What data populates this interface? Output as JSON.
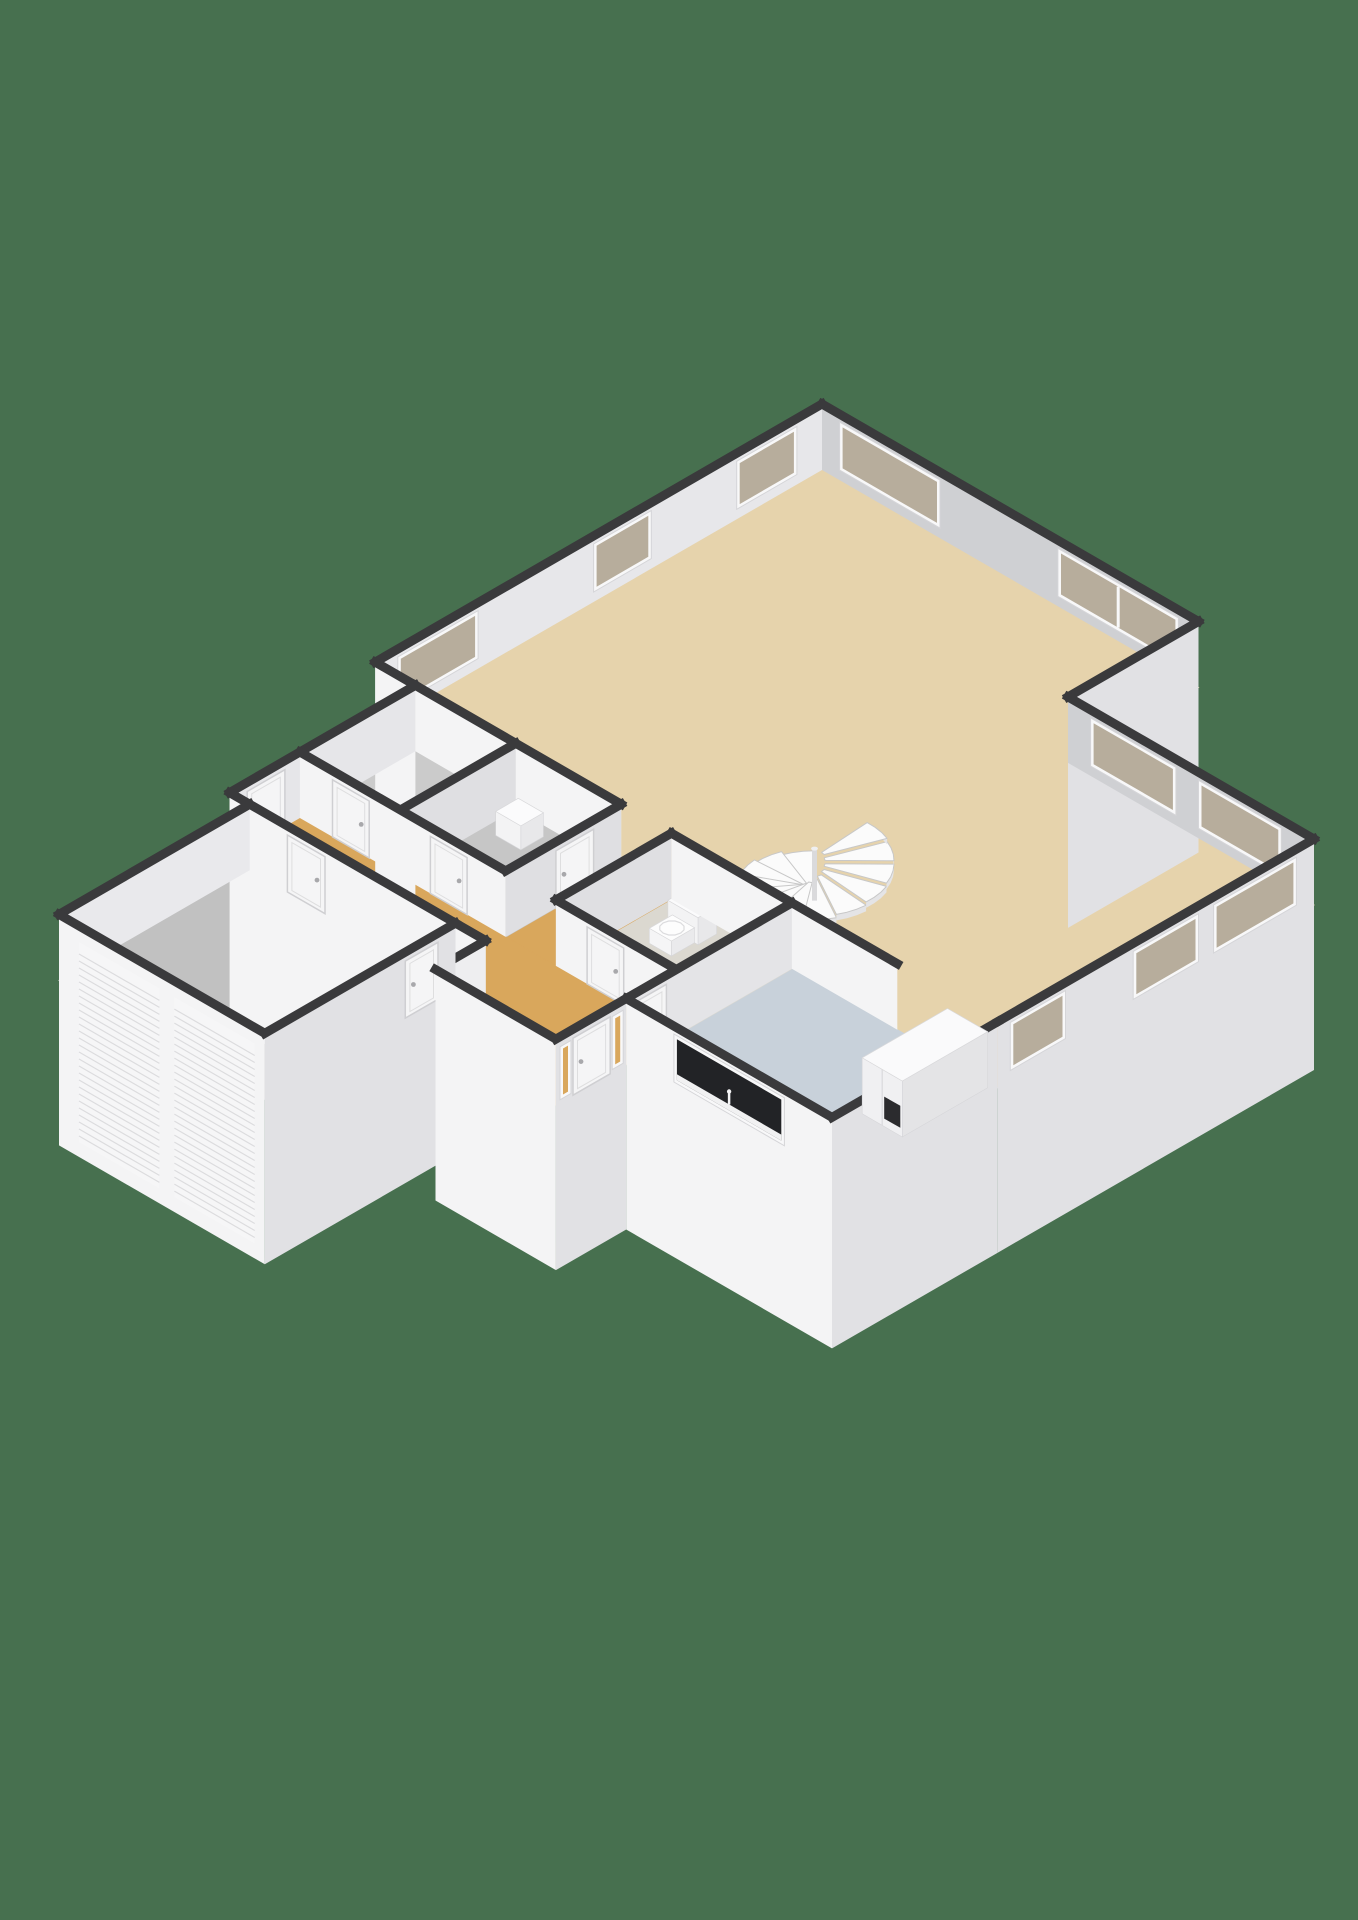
{
  "scene": {
    "title": "3d-floorplan-ground-floor",
    "background": "#47704F",
    "wall_cap": "#3a3a3c",
    "face_light": "#f4f4f5",
    "face_dark": "#e1e1e4",
    "frame": "#f8f8f9",
    "frame_stroke": "#d5d5d8",
    "glass_beige": "#b7ad9c",
    "glass_dark": "#222326",
    "glass_orange": "#d9a75c",
    "step_top": "#fbfbfb",
    "step_edge": "#c8c8c8",
    "step_riser": "#e4e4e6",
    "slat_line": "#dcdcde",
    "door_fill": "#f5f5f6",
    "door_stroke": "#cfcfd2",
    "handle": "#a8a8ab"
  },
  "iso": {
    "cx": 822,
    "cy": 470,
    "hx": 50.2,
    "vy": 29,
    "wall_h": 66,
    "skirt": 165,
    "cap_w": 9
  },
  "rooms": [
    {
      "id": "living-room",
      "color": "#e6d3ac"
    },
    {
      "id": "kitchen",
      "color": "#c8d1da"
    },
    {
      "id": "wc",
      "color": "#dbd8d0"
    },
    {
      "id": "corridor",
      "color": "#d9a75c"
    },
    {
      "id": "storage-a",
      "color": "#cbcbcb"
    },
    {
      "id": "storage-b",
      "color": "#c6c6c6"
    },
    {
      "id": "hallway",
      "color": "#d9a75c"
    },
    {
      "id": "garage",
      "color": "#c1c1c1"
    }
  ],
  "floors": [
    {
      "name": "floor-living-room",
      "color": "#e6d3ac",
      "pts": [
        [
          0,
          0
        ],
        [
          7.5,
          0
        ],
        [
          7.5,
          2.6
        ],
        [
          12.4,
          2.6
        ],
        [
          12.4,
          8.9
        ],
        [
          0,
          8.9
        ]
      ]
    },
    {
      "name": "floor-kitchen",
      "color": "#c8d1da",
      "pts": [
        [
          8.3,
          8.9
        ],
        [
          12.4,
          8.9
        ],
        [
          12.4,
          12.2
        ],
        [
          8.3,
          12.2
        ]
      ]
    },
    {
      "name": "floor-wc",
      "color": "#dbd8d0",
      "pts": [
        [
          5.9,
          8.9
        ],
        [
          8.3,
          8.9
        ],
        [
          8.3,
          11.2
        ],
        [
          5.9,
          11.2
        ]
      ]
    },
    {
      "name": "floor-corridor",
      "color": "#d9a75c",
      "pts": [
        [
          4.9,
          8.9
        ],
        [
          5.9,
          8.9
        ],
        [
          5.9,
          11.2
        ],
        [
          4.9,
          11.2
        ]
      ]
    },
    {
      "name": "floor-storage-a",
      "color": "#cbcbcb",
      "pts": [
        [
          0.8,
          8.9
        ],
        [
          2.8,
          8.9
        ],
        [
          2.8,
          11.2
        ],
        [
          0.8,
          11.2
        ]
      ]
    },
    {
      "name": "floor-storage-b",
      "color": "#c6c6c6",
      "pts": [
        [
          2.8,
          8.9
        ],
        [
          4.9,
          8.9
        ],
        [
          4.9,
          11.2
        ],
        [
          2.8,
          11.2
        ]
      ]
    },
    {
      "name": "floor-hallway",
      "color": "#d9a75c",
      "pts": [
        [
          0.8,
          11.2
        ],
        [
          8.3,
          11.2
        ],
        [
          8.3,
          13.6
        ],
        [
          5.9,
          13.6
        ],
        [
          5.9,
          12.6
        ],
        [
          0.8,
          12.6
        ]
      ]
    },
    {
      "name": "floor-garage",
      "color": "#c1c1c1",
      "pts": [
        [
          1.2,
          12.6
        ],
        [
          5.3,
          12.6
        ],
        [
          5.3,
          16.4
        ],
        [
          1.2,
          16.4
        ]
      ]
    }
  ],
  "walls": [
    {
      "name": "wall-living-north",
      "p1": [
        0,
        0
      ],
      "p2": [
        7.5,
        0
      ],
      "tone": "#cfd0d3",
      "windows": [
        {
          "d": [
            0.35,
            2.35
          ]
        },
        {
          "d": [
            4.7,
            7.1
          ]
        }
      ]
    },
    {
      "name": "wall-notch",
      "p1": [
        7.5,
        0
      ],
      "p2": [
        7.5,
        2.6
      ],
      "skirt": true,
      "windows": []
    },
    {
      "name": "wall-living-northeast",
      "p1": [
        7.5,
        2.6
      ],
      "p2": [
        12.4,
        2.6
      ],
      "tone": "#cfd0d3",
      "windows": [
        {
          "d": [
            0.45,
            2.15
          ]
        },
        {
          "d": [
            2.6,
            4.25
          ]
        }
      ]
    },
    {
      "name": "wall-living-east",
      "p1": [
        12.4,
        2.6
      ],
      "p2": [
        12.4,
        8.9
      ],
      "skirt": true,
      "windows": [
        {
          "d": [
            0.35,
            2.0
          ]
        },
        {
          "d": [
            2.3,
            3.6
          ]
        },
        {
          "d": [
            4.95,
            6.05
          ]
        }
      ]
    },
    {
      "name": "wall-kitchen-east",
      "p1": [
        12.4,
        8.9
      ],
      "p2": [
        12.4,
        12.2
      ],
      "skirt": true,
      "windows": []
    },
    {
      "name": "wall-kitchen-south",
      "p1": [
        8.3,
        12.2
      ],
      "p2": [
        12.4,
        12.2
      ],
      "skirt": true,
      "windows": [
        {
          "d": [
            0.95,
            3.15
          ],
          "glass": "#222326",
          "decor": "sink"
        }
      ]
    },
    {
      "name": "wall-entrance",
      "p1": [
        8.3,
        12.2
      ],
      "p2": [
        8.3,
        13.6
      ],
      "skirt": true,
      "windows": [
        {
          "d": [
            0.06,
            0.28
          ],
          "z": [
            3,
            56
          ],
          "glass": "#d9a75c"
        },
        {
          "d": [
            1.1,
            1.32
          ],
          "z": [
            3,
            56
          ],
          "glass": "#d9a75c"
        }
      ],
      "doors": [
        {
          "d": [
            0.32,
            1.06
          ],
          "name": "front-door"
        }
      ]
    },
    {
      "name": "wall-vestibule-south",
      "p1": [
        5.9,
        13.6
      ],
      "p2": [
        8.3,
        13.6
      ],
      "skirt": true
    },
    {
      "name": "wall-vestibule-west",
      "p1": [
        5.9,
        12.6
      ],
      "p2": [
        5.9,
        13.6
      ],
      "tone": "#eeeef0"
    },
    {
      "name": "wall-gap",
      "p1": [
        5.3,
        12.6
      ],
      "p2": [
        5.9,
        12.6
      ],
      "skirt": true
    },
    {
      "name": "wall-garage-east",
      "p1": [
        5.3,
        12.6
      ],
      "p2": [
        5.3,
        16.4
      ],
      "skirt": true,
      "doors": [
        {
          "d": [
            0.35,
            1.0
          ],
          "name": "garage-side-door"
        }
      ]
    },
    {
      "name": "wall-garage-south",
      "p1": [
        1.2,
        16.4
      ],
      "p2": [
        5.3,
        16.4
      ],
      "skirt": true,
      "slats": [
        [
          0.4,
          2.0
        ],
        [
          2.3,
          3.9
        ]
      ]
    },
    {
      "name": "wall-garage-west",
      "p1": [
        1.2,
        12.6
      ],
      "p2": [
        1.2,
        16.4
      ],
      "tone": "#e9e9ec"
    },
    {
      "name": "wall-garage-north",
      "p1": [
        0.8,
        12.6
      ],
      "p2": [
        5.3,
        12.6
      ],
      "skirt": true,
      "doors": [
        {
          "d": [
            1.15,
            1.9
          ],
          "name": "garage-hall-door"
        }
      ]
    },
    {
      "name": "wall-jog",
      "p1": [
        0,
        8.9
      ],
      "p2": [
        0.8,
        8.9
      ],
      "skirt": true
    },
    {
      "name": "wall-hall-west",
      "p1": [
        0.8,
        8.9
      ],
      "p2": [
        0.8,
        12.6
      ],
      "tone": "#e6e6e9",
      "doors": [
        {
          "d": [
            2.6,
            3.35
          ],
          "name": "side-entrance-door"
        }
      ]
    },
    {
      "name": "wall-living-west",
      "p1": [
        0,
        0
      ],
      "p2": [
        0,
        8.9
      ],
      "tone": "#e7e7ea",
      "windows": [
        {
          "d": [
            0.5,
            1.7
          ]
        },
        {
          "d": [
            3.4,
            4.55
          ]
        },
        {
          "d": [
            6.85,
            8.45
          ]
        }
      ]
    },
    {
      "name": "wall-utility-north",
      "p1": [
        0.8,
        8.9
      ],
      "p2": [
        4.9,
        8.9
      ]
    },
    {
      "name": "wall-kitchen-north",
      "p1": [
        5.9,
        8.9
      ],
      "p2": [
        10.4,
        8.9
      ]
    },
    {
      "name": "wall-storage-divider",
      "p1": [
        2.8,
        8.9
      ],
      "p2": [
        2.8,
        11.2
      ],
      "tone": "#dfdfe2"
    },
    {
      "name": "wall-corridor-west",
      "p1": [
        4.9,
        8.9
      ],
      "p2": [
        4.9,
        11.2
      ],
      "tone": "#dfdfe2",
      "doors": [
        {
          "d": [
            0.55,
            1.3
          ],
          "name": "storage-b-door"
        }
      ]
    },
    {
      "name": "wall-corridor-east",
      "p1": [
        5.9,
        8.9
      ],
      "p2": [
        5.9,
        11.2
      ],
      "tone": "#dfdfe2"
    },
    {
      "name": "wall-kitchen-west",
      "p1": [
        8.3,
        8.9
      ],
      "p2": [
        8.3,
        12.2
      ],
      "tone": "#e4e4e7",
      "doors": [
        {
          "d": [
            2.5,
            3.2
          ],
          "name": "kitchen-door"
        }
      ]
    },
    {
      "name": "wall-utility-south",
      "p1": [
        0.8,
        11.2
      ],
      "p2": [
        4.9,
        11.2
      ],
      "doors": [
        {
          "d": [
            0.65,
            1.38
          ],
          "name": "storage-a-door"
        },
        {
          "d": [
            2.6,
            3.33
          ],
          "name": "storage-b-hall-door"
        }
      ]
    },
    {
      "name": "wall-wc-south",
      "p1": [
        5.9,
        11.2
      ],
      "p2": [
        8.3,
        11.2
      ],
      "doors": [
        {
          "d": [
            0.62,
            1.35
          ],
          "name": "wc-door"
        }
      ]
    }
  ],
  "boxes": [
    {
      "name": "kitchen-cabinets",
      "x0": 11.5,
      "y0": 9.0,
      "x1": 12.3,
      "y1": 10.7,
      "h": 56,
      "top": "#fafafb",
      "fa": "#e4e4e6",
      "fb": "#f0f0f2",
      "divider": true,
      "panel": {
        "t0": 0.55,
        "t1": 0.95,
        "z0": 8,
        "z1": 30,
        "color": "#2b2b2e"
      }
    },
    {
      "name": "boiler-unit",
      "x0": 3.05,
      "y0": 9.1,
      "x1": 3.55,
      "y1": 9.55,
      "h": 24,
      "top": "#fbfbfc",
      "fa": "#e8e8ea",
      "fb": "#f3f3f4"
    },
    {
      "name": "toilet-cistern",
      "x0": 6.35,
      "y0": 9.05,
      "x1": 6.95,
      "y1": 9.42,
      "h": 27,
      "top": "#fbfbfc",
      "fa": "#e8e8ea",
      "fb": "#f3f3f4",
      "dots": true
    },
    {
      "name": "toilet-bowl",
      "x0": 6.44,
      "y0": 9.42,
      "x1": 6.88,
      "y1": 9.88,
      "h": 15,
      "top": "#fdfdfd",
      "fa": "#eaeaec",
      "fb": "#f5f5f6",
      "seat": true
    }
  ],
  "stairs": {
    "name": "spiral-staircase",
    "cx": 7.35,
    "cy": 7.5,
    "r_out": 1.12,
    "r_in": 0.15,
    "steps": 13,
    "start_deg": 225,
    "step_deg": -24.5,
    "base_z": 4,
    "rise": 3.3,
    "pole_h": 52
  }
}
